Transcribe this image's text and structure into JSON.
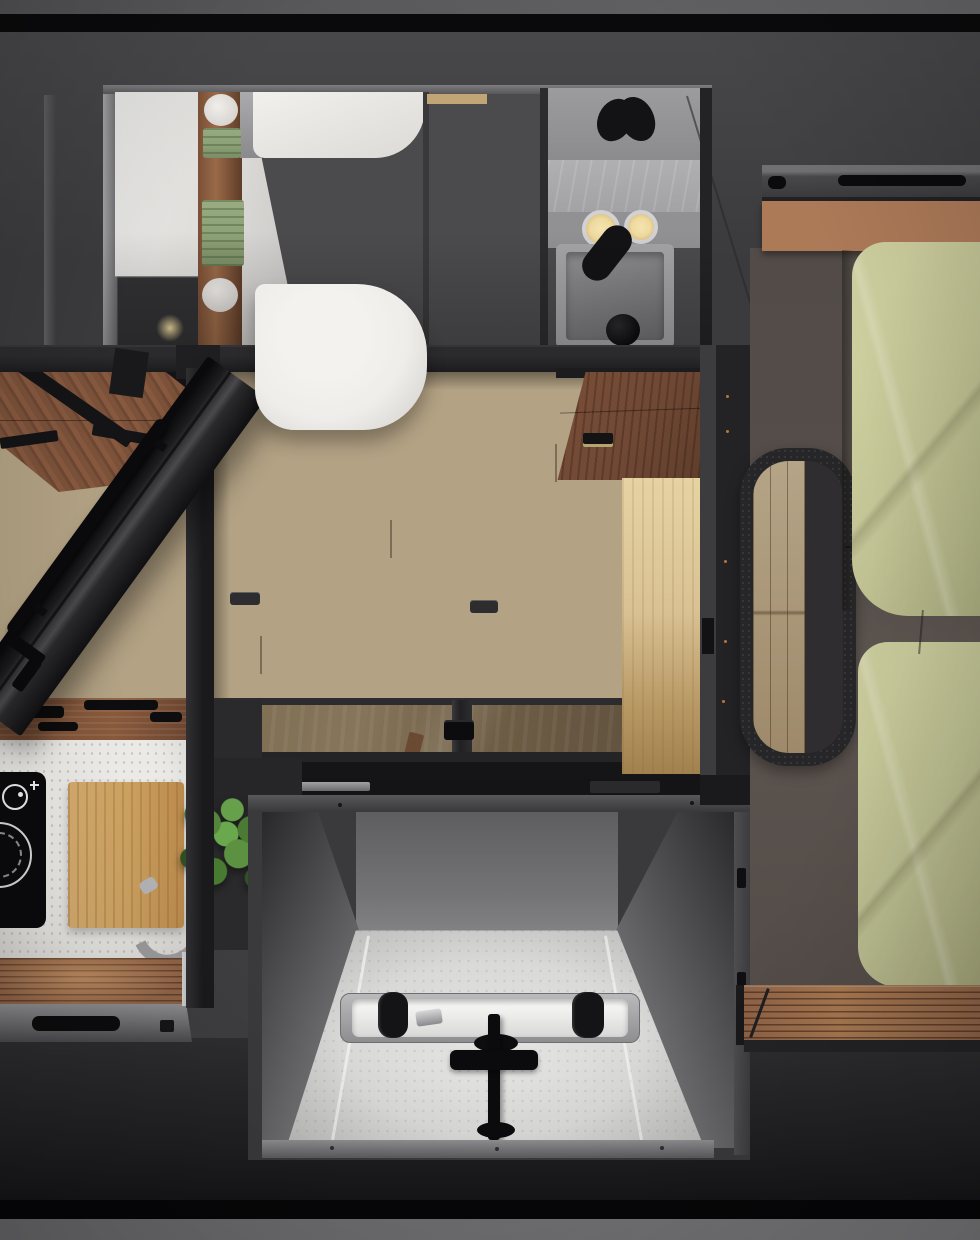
{
  "scene": {
    "type": "photorealistic-3d-render",
    "view": "top-down bird's-eye floor plan of a camper-van interior",
    "no_visible_text": true,
    "areas": {
      "bathroom": {
        "position": "top-left",
        "objects": [
          "white toilet tank",
          "white toilet bowl with closed lid",
          "white wall panels",
          "walnut shelf column",
          "two toilet-paper rolls",
          "two stacks of green towels",
          "storage niche with warm light",
          "gray vanity counter",
          "rectangular wash basin",
          "black curved faucet and mirror reflection",
          "two round warm mirror lights",
          "black drain cup",
          "mirror seam"
        ]
      },
      "hallway": {
        "position": "centre",
        "objects": [
          "light oak plank floor",
          "two recessed floor latches",
          "open dark bathroom door with long black handle bar",
          "black frame beam",
          "black vertical posts",
          "walnut overhead cabinet with recessed handle",
          "lit oak wardrobe side panel"
        ]
      },
      "dinette": {
        "position": "middle-left",
        "objects": [
          "walnut table top with diagonal grain",
          "black metal table legs"
        ]
      },
      "bedroom": {
        "position": "right",
        "objects": [
          "gray storage ledge with black handle slots",
          "walnut headboard shelf",
          "two olive-green pillows",
          "dark brown upholstered bed base",
          "rounded black entry-step cutout showing oak floor below",
          "teak slat foot bench"
        ]
      },
      "glass_hatch": {
        "position": "centre, below hallway",
        "objects": [
          "two tinted glass panels reflecting wood floor",
          "centre mullion",
          "small black pull handle",
          "dark sliding track with steel hardware"
        ]
      },
      "galley": {
        "position": "bottom-centre, sunken",
        "objects": [
          "concrete back wall",
          "light stone counter floor with edge lighting",
          "stainless trough sink with white-lit basin",
          "two black cups in sink",
          "chrome fitting",
          "black plan-view faucet with cross handle",
          "lit front rim",
          "side wall with hinge slots"
        ]
      },
      "kitchen": {
        "position": "bottom-left",
        "objects": [
          "black induction cooktop with white ring and dial graphic",
          "white speckled countertop",
          "bamboo cutting board",
          "curved steel handle",
          "green potted plant",
          "walnut ceiling strip with black slats",
          "teak slat counter",
          "gray trim with black recessed drawer handle"
        ]
      },
      "body": {
        "position": "edges",
        "objects": [
          "dark gray van body panels",
          "black border bands top and bottom",
          "light gray outer strips top and bottom"
        ]
      }
    }
  },
  "palette": {
    "roof": "#59595b",
    "band-black": "#0a0a0c",
    "wall": "#3e3e40",
    "body-dark": "#262628",
    "bath-bg": "#4b4b4d",
    "panel-white": "#e0dedb",
    "porcelain": "#efede9",
    "walnut": "#8a5a3c",
    "walnut-dark": "#6f4834",
    "shelf-wood": "#ad7a58",
    "oak-floor": "#b3a284",
    "oak-panel": "#d9c193",
    "towel-green": "#8ba075",
    "pillow-green": "#c0c293",
    "bed-base": "#564e4a",
    "teak": "#9c6d4b",
    "counter-white": "#e9e8e4",
    "bamboo": "#cfa462",
    "galley-floor": "#d9d9d7",
    "concrete": "#747476",
    "steel": "#9b9b9d",
    "glass-bronze": "#86755a",
    "frame-black": "#232325",
    "warm-light": "#eeda9f",
    "plant-green": "#4e7d36"
  }
}
